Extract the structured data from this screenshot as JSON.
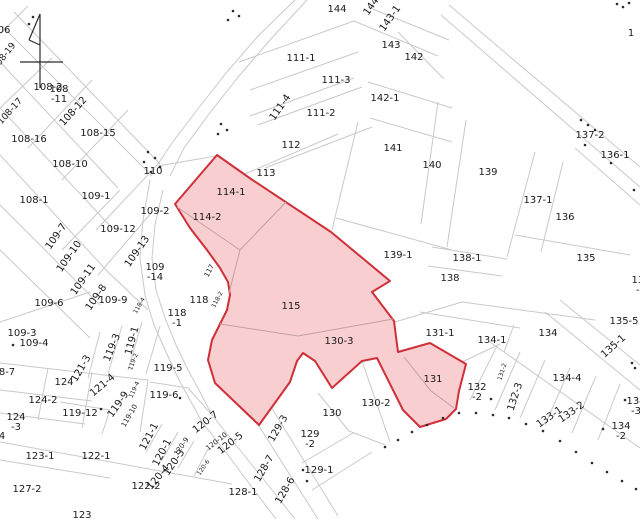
{
  "map": {
    "description": "cadastral-parcel-map",
    "colors": {
      "background": "#ffffff",
      "parcel_line": "#c9c9c9",
      "label_text": "#1a1a1a",
      "highlight_fill": "#f7c6c8",
      "highlight_stroke": "#cf3038",
      "marker_black": "#2b2b2b"
    },
    "highlighted_parcels": [
      "114-1",
      "114-2",
      "115",
      "130-3",
      "131"
    ],
    "labels": [
      {
        "t": "06",
        "x": 4,
        "y": 31
      },
      {
        "t": "108-19",
        "x": 5,
        "y": 57,
        "r": -52,
        "s": 9
      },
      {
        "t": "108-2",
        "x": 48,
        "y": 88
      },
      {
        "t": "108\n-11",
        "x": 59,
        "y": 95
      },
      {
        "t": "108-12",
        "x": 74,
        "y": 112,
        "r": -48
      },
      {
        "t": "108-17",
        "x": 11,
        "y": 112,
        "r": -48,
        "s": 9
      },
      {
        "t": "108-15",
        "x": 98,
        "y": 134
      },
      {
        "t": "108-16",
        "x": 29,
        "y": 140
      },
      {
        "t": "108-10",
        "x": 70,
        "y": 165
      },
      {
        "t": "110",
        "x": 153,
        "y": 172
      },
      {
        "t": "108-1",
        "x": 34,
        "y": 201
      },
      {
        "t": "109-1",
        "x": 96,
        "y": 197
      },
      {
        "t": "109-2",
        "x": 155,
        "y": 212
      },
      {
        "t": "109-7",
        "x": 57,
        "y": 237,
        "r": -55
      },
      {
        "t": "109-12",
        "x": 118,
        "y": 230
      },
      {
        "t": "109-10",
        "x": 70,
        "y": 257,
        "r": -55
      },
      {
        "t": "109-13",
        "x": 138,
        "y": 252,
        "r": -55
      },
      {
        "t": "109-11",
        "x": 84,
        "y": 280,
        "r": -55
      },
      {
        "t": "109\n-14",
        "x": 155,
        "y": 273
      },
      {
        "t": "109-8",
        "x": 97,
        "y": 298,
        "r": -55
      },
      {
        "t": "109-9",
        "x": 113,
        "y": 301
      },
      {
        "t": "109-6",
        "x": 49,
        "y": 304
      },
      {
        "t": "117",
        "x": 210,
        "y": 271,
        "r": -62,
        "s": 7
      },
      {
        "t": "118",
        "x": 199,
        "y": 301
      },
      {
        "t": "118-2",
        "x": 218,
        "y": 300,
        "r": -62,
        "s": 6
      },
      {
        "t": "118-4",
        "x": 140,
        "y": 306,
        "r": -60,
        "s": 6
      },
      {
        "t": "118\n-1",
        "x": 177,
        "y": 319
      },
      {
        "t": "109-3",
        "x": 22,
        "y": 334
      },
      {
        "t": "109-4",
        "x": 34,
        "y": 344
      },
      {
        "t": "8-7",
        "x": 7,
        "y": 373
      },
      {
        "t": "124",
        "x": 64,
        "y": 383
      },
      {
        "t": "121-3",
        "x": 82,
        "y": 369,
        "r": -60
      },
      {
        "t": "119-3",
        "x": 113,
        "y": 348,
        "r": -68
      },
      {
        "t": "119-1",
        "x": 133,
        "y": 341,
        "r": -75
      },
      {
        "t": "119-2",
        "x": 134,
        "y": 362,
        "r": -70,
        "s": 6
      },
      {
        "t": "119-5",
        "x": 168,
        "y": 369
      },
      {
        "t": "124-2",
        "x": 43,
        "y": 401
      },
      {
        "t": "121-4",
        "x": 103,
        "y": 386,
        "r": -40
      },
      {
        "t": "119-12",
        "x": 80,
        "y": 414
      },
      {
        "t": "119-9",
        "x": 119,
        "y": 405,
        "r": -55
      },
      {
        "t": "119-4",
        "x": 135,
        "y": 390,
        "r": -65,
        "s": 6
      },
      {
        "t": "119-10",
        "x": 130,
        "y": 416,
        "r": -60,
        "s": 7
      },
      {
        "t": "119-6",
        "x": 164,
        "y": 396
      },
      {
        "t": "124\n-3",
        "x": 16,
        "y": 423
      },
      {
        "t": "4",
        "x": 2,
        "y": 437
      },
      {
        "t": "121-1",
        "x": 150,
        "y": 437,
        "r": -62
      },
      {
        "t": "120-1",
        "x": 163,
        "y": 453,
        "r": -62
      },
      {
        "t": "120-7",
        "x": 206,
        "y": 423,
        "r": -38
      },
      {
        "t": "120-10",
        "x": 217,
        "y": 442,
        "r": -38,
        "s": 7
      },
      {
        "t": "120-9",
        "x": 182,
        "y": 447,
        "r": -55,
        "s": 7
      },
      {
        "t": "120-3",
        "x": 175,
        "y": 463,
        "r": -55
      },
      {
        "t": "120-5",
        "x": 231,
        "y": 444,
        "r": -38
      },
      {
        "t": "120-4",
        "x": 159,
        "y": 478,
        "r": -50
      },
      {
        "t": "120-6",
        "x": 204,
        "y": 468,
        "r": -55,
        "s": 6
      },
      {
        "t": "123-1",
        "x": 40,
        "y": 457
      },
      {
        "t": "122-1",
        "x": 96,
        "y": 457
      },
      {
        "t": "127-2",
        "x": 27,
        "y": 490
      },
      {
        "t": "122-2",
        "x": 146,
        "y": 487
      },
      {
        "t": "123",
        "x": 82,
        "y": 516
      },
      {
        "t": "128-1",
        "x": 243,
        "y": 493
      },
      {
        "t": "128-7",
        "x": 265,
        "y": 469,
        "r": -60
      },
      {
        "t": "128-6",
        "x": 286,
        "y": 491,
        "r": -60
      },
      {
        "t": "129-3",
        "x": 279,
        "y": 429,
        "r": -60
      },
      {
        "t": "129\n-2",
        "x": 310,
        "y": 440
      },
      {
        "t": "129-1",
        "x": 319,
        "y": 471
      },
      {
        "t": "130",
        "x": 332,
        "y": 414
      },
      {
        "t": "130-2",
        "x": 376,
        "y": 404
      },
      {
        "t": "130-3",
        "x": 339,
        "y": 342
      },
      {
        "t": "115",
        "x": 291,
        "y": 307
      },
      {
        "t": "114-1",
        "x": 231,
        "y": 193
      },
      {
        "t": "114-2",
        "x": 207,
        "y": 218
      },
      {
        "t": "113",
        "x": 266,
        "y": 174
      },
      {
        "t": "112",
        "x": 291,
        "y": 146
      },
      {
        "t": "111-1",
        "x": 301,
        "y": 59
      },
      {
        "t": "111-3",
        "x": 336,
        "y": 81
      },
      {
        "t": "111-2",
        "x": 321,
        "y": 114
      },
      {
        "t": "111-4",
        "x": 281,
        "y": 108,
        "r": -55
      },
      {
        "t": "144",
        "x": 337,
        "y": 10
      },
      {
        "t": "144",
        "x": 372,
        "y": 7,
        "r": -55
      },
      {
        "t": "143-1",
        "x": 391,
        "y": 19,
        "r": -55
      },
      {
        "t": "143",
        "x": 391,
        "y": 46
      },
      {
        "t": "142",
        "x": 414,
        "y": 58
      },
      {
        "t": "142-1",
        "x": 385,
        "y": 99
      },
      {
        "t": "141",
        "x": 393,
        "y": 149
      },
      {
        "t": "140",
        "x": 432,
        "y": 166
      },
      {
        "t": "139",
        "x": 488,
        "y": 173
      },
      {
        "t": "137-1",
        "x": 538,
        "y": 201
      },
      {
        "t": "136",
        "x": 565,
        "y": 218
      },
      {
        "t": "137-2",
        "x": 590,
        "y": 136
      },
      {
        "t": "136-1",
        "x": 615,
        "y": 156
      },
      {
        "t": "1",
        "x": 631,
        "y": 34
      },
      {
        "t": "139-1",
        "x": 398,
        "y": 256
      },
      {
        "t": "138-1",
        "x": 467,
        "y": 259
      },
      {
        "t": "138",
        "x": 450,
        "y": 279
      },
      {
        "t": "135",
        "x": 586,
        "y": 259
      },
      {
        "t": "131-1",
        "x": 440,
        "y": 334
      },
      {
        "t": "131",
        "x": 433,
        "y": 380
      },
      {
        "t": "132\n-2",
        "x": 477,
        "y": 393
      },
      {
        "t": "132-3",
        "x": 516,
        "y": 397,
        "r": -72
      },
      {
        "t": "131-2",
        "x": 503,
        "y": 372,
        "r": -72,
        "s": 6
      },
      {
        "t": "133-1",
        "x": 550,
        "y": 418,
        "r": -35
      },
      {
        "t": "133-2",
        "x": 572,
        "y": 413,
        "r": -35
      },
      {
        "t": "134-1",
        "x": 492,
        "y": 341
      },
      {
        "t": "134",
        "x": 548,
        "y": 334
      },
      {
        "t": "134-4",
        "x": 567,
        "y": 379
      },
      {
        "t": "135-5",
        "x": 624,
        "y": 322
      },
      {
        "t": "135-1",
        "x": 614,
        "y": 347,
        "r": -42
      },
      {
        "t": "134\n-3",
        "x": 636,
        "y": 407
      },
      {
        "t": "134\n-2",
        "x": 621,
        "y": 432
      },
      {
        "t": "135\n-2",
        "x": 641,
        "y": 286
      }
    ],
    "dots": [
      [
        148,
        152
      ],
      [
        155,
        158
      ],
      [
        144,
        162
      ],
      [
        160,
        167
      ],
      [
        151,
        172
      ],
      [
        233,
        11
      ],
      [
        239,
        16
      ],
      [
        228,
        20
      ],
      [
        221,
        124
      ],
      [
        227,
        130
      ],
      [
        218,
        134
      ],
      [
        585,
        145
      ],
      [
        611,
        163
      ],
      [
        581,
        120
      ],
      [
        588,
        125
      ],
      [
        595,
        130
      ],
      [
        617,
        4
      ],
      [
        623,
        7
      ],
      [
        629,
        3
      ],
      [
        385,
        447
      ],
      [
        398,
        440
      ],
      [
        412,
        432
      ],
      [
        427,
        425
      ],
      [
        443,
        418
      ],
      [
        459,
        413
      ],
      [
        476,
        413
      ],
      [
        493,
        415
      ],
      [
        509,
        418
      ],
      [
        526,
        424
      ],
      [
        543,
        431
      ],
      [
        560,
        441
      ],
      [
        576,
        452
      ],
      [
        592,
        463
      ],
      [
        607,
        472
      ],
      [
        622,
        481
      ],
      [
        636,
        489
      ],
      [
        303,
        470
      ],
      [
        307,
        481
      ],
      [
        491,
        399
      ],
      [
        603,
        429
      ],
      [
        625,
        400
      ],
      [
        13,
        345
      ],
      [
        101,
        409
      ],
      [
        180,
        398
      ],
      [
        632,
        363
      ],
      [
        635,
        368
      ],
      [
        33,
        17
      ],
      [
        29,
        24
      ],
      [
        634,
        190
      ]
    ]
  }
}
